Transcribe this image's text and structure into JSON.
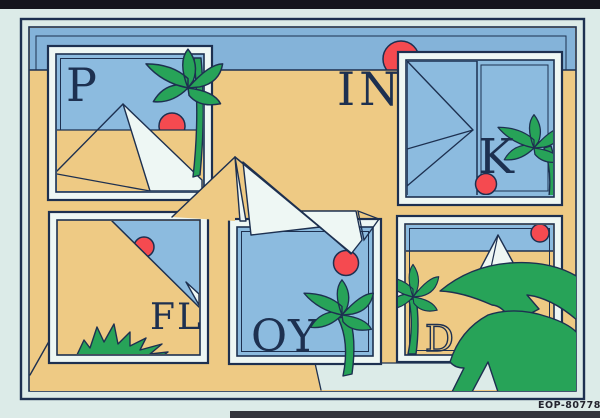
{
  "poster": {
    "letters": {
      "panel_p": "P",
      "field_in": "IN",
      "panel_k": "K",
      "panel_fl": "FL",
      "panel_oy": "OY",
      "panel_d": "D"
    },
    "catalog_code": "EOP-80778",
    "colors": {
      "paper": "#dcebe8",
      "dark": "#15151d",
      "navy": "#1d3050",
      "sand": "#eeca84",
      "sky": "#84b3d9",
      "panel_sky": "#8cbbdf",
      "white": "#eef7f4",
      "pale_blue": "#cfe7ec",
      "green": "#27a358",
      "red": "#f54a50"
    }
  }
}
